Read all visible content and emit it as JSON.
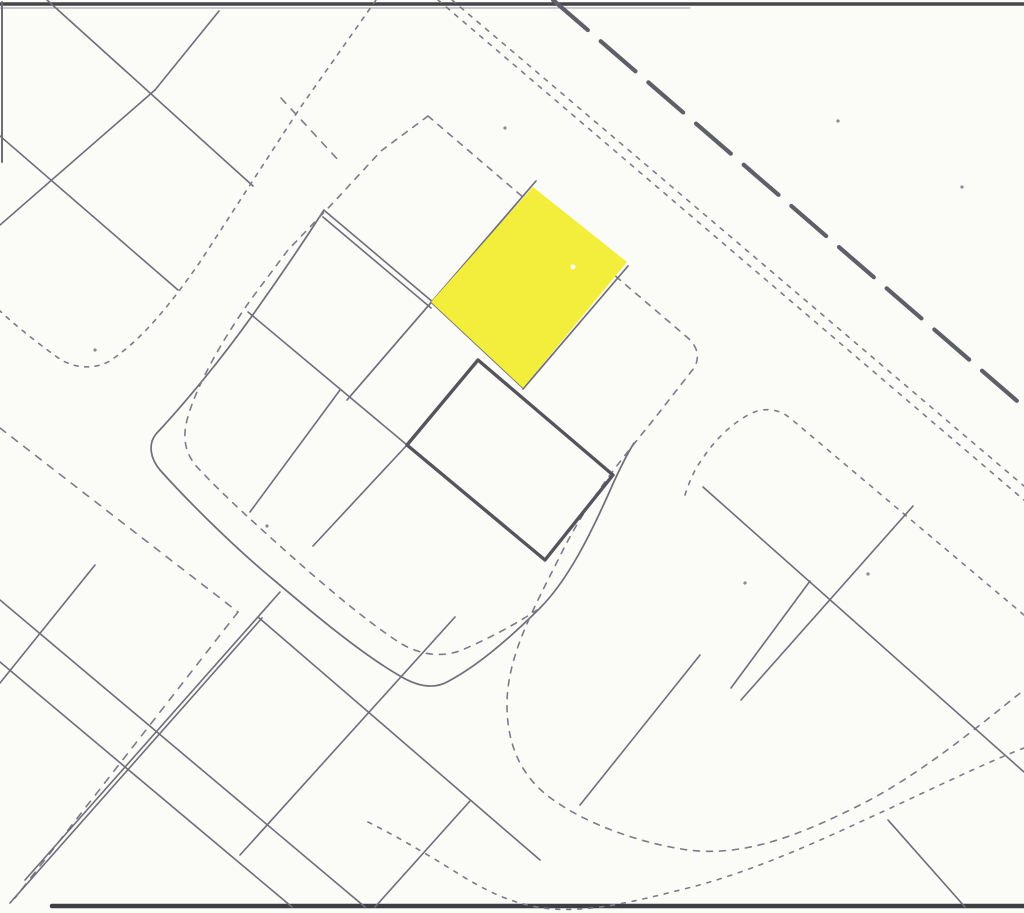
{
  "map": {
    "kind": "cadastral-parcel-plan-scan",
    "canvas": {
      "width": 1024,
      "height": 913
    },
    "palette": {
      "background": "#fbfbf8",
      "parcel_line": "#6e6e79",
      "dotted_boundary": "#7c7c87",
      "bold_parcel_outline": "#54545c",
      "road_dash": "#5f5f68",
      "scan_border": "#45454c",
      "highlight_parcel": "#f2ee3b"
    },
    "highlighted_parcel": {
      "name": "highlighted-parcel",
      "fill": "#f2ee3b",
      "corners": [
        [
          533,
          187
        ],
        [
          627,
          262
        ],
        [
          523,
          388
        ],
        [
          431,
          302
        ]
      ]
    },
    "features": [
      {
        "name": "top-scan-border",
        "type": "line",
        "x1": 0,
        "y1": 4,
        "x2": 1024,
        "y2": 4,
        "stroke": "#45454c",
        "width": 3.5
      },
      {
        "name": "top-scan-border-echo",
        "type": "line",
        "x1": 0,
        "y1": 8,
        "x2": 690,
        "y2": 8,
        "stroke": "#9a9aa2",
        "width": 1
      },
      {
        "name": "bottom-scan-border",
        "type": "line",
        "x1": 52,
        "y1": 906,
        "x2": 1024,
        "y2": 906,
        "stroke": "#3d3d44",
        "width": 4.5
      },
      {
        "name": "left-scan-border",
        "type": "line",
        "x1": 2,
        "y1": 2,
        "x2": 2,
        "y2": 162,
        "stroke": "#6d6d75",
        "width": 2
      },
      {
        "name": "road-long-dash",
        "type": "line",
        "x1": 553,
        "y1": 0,
        "x2": 1024,
        "y2": 407,
        "stroke": "#5f5f68",
        "width": 4.2,
        "dash": "46 17"
      },
      {
        "name": "road-dotted-edge-a",
        "type": "line",
        "x1": 438,
        "y1": 0,
        "x2": 1024,
        "y2": 500,
        "stroke": "#7c7c87",
        "width": 1.6,
        "dash": "4 7"
      },
      {
        "name": "road-dotted-edge-b",
        "type": "line",
        "x1": 452,
        "y1": 0,
        "x2": 1024,
        "y2": 486,
        "stroke": "#7c7c87",
        "width": 1.6,
        "dash": "4 7"
      },
      {
        "name": "topleft-parcel-line-a",
        "type": "line",
        "x1": 47,
        "y1": 0,
        "x2": 253,
        "y2": 186,
        "stroke": "#6e6e79",
        "width": 1.6
      },
      {
        "name": "topleft-parcel-line-b",
        "type": "line",
        "x1": 155,
        "y1": 90,
        "x2": 0,
        "y2": 225,
        "stroke": "#6e6e79",
        "width": 1.6
      },
      {
        "name": "topleft-parcel-line-b2",
        "type": "line",
        "x1": 155,
        "y1": 90,
        "x2": 219,
        "y2": 11,
        "stroke": "#6e6e79",
        "width": 1.6
      },
      {
        "name": "topleft-parcel-line-c",
        "type": "line",
        "x1": 0,
        "y1": 136,
        "x2": 178,
        "y2": 290,
        "stroke": "#6e6e79",
        "width": 1.6
      },
      {
        "name": "topleft-block-dotted-boundary",
        "type": "path",
        "d": "M376 0 L300 108 L200 262 C170 305 140 342 108 362 C92 370 72 368 57 357 C36 342 15 325 0 311",
        "stroke": "#7c7c87",
        "width": 1.6,
        "dash": "4 6.5"
      },
      {
        "name": "street-dash-fragment",
        "type": "line",
        "x1": 281,
        "y1": 98,
        "x2": 340,
        "y2": 162,
        "stroke": "#7c7c87",
        "width": 1.6,
        "dash": "7 8"
      },
      {
        "name": "center-block-solid-boundary",
        "type": "path",
        "d": "M324 210 C295 255 272 288 252 316 C222 358 186 402 156 434 C148 444 150 458 160 470 C185 498 225 538 262 570 C300 602 355 650 400 676 C415 685 432 690 447 682 C478 666 512 636 540 608 C568 580 590 535 608 495 C618 472 626 456 634 443",
        "stroke": "#6e6e79",
        "width": 1.7
      },
      {
        "name": "center-block-dotted-west",
        "type": "path",
        "d": "M428 116 L381 151 L333 203 L288 250 L252 298 C222 340 196 386 187 420 C182 440 186 455 198 468 C225 497 262 530 298 562 C330 590 365 620 400 643 C420 655 442 658 462 650 C490 638 516 624 537 610",
        "stroke": "#7c7c87",
        "width": 1.6,
        "dash": "6 7"
      },
      {
        "name": "center-block-dotted-east-and-street-sweep",
        "type": "path",
        "d": "M428 116 L688 338 C698 347 700 358 694 368 L658 414 C628 452 590 495 560 556 C532 612 506 658 507 708 C508 750 524 779 552 799 C585 823 638 843 688 850 C745 857 800 835 860 805 C920 775 980 725 1024 690",
        "stroke": "#7c7c87",
        "width": 1.6,
        "dash": "6 7"
      },
      {
        "name": "street-sweep-outer-dotted",
        "type": "path",
        "d": "M368 822 C400 838 430 856 462 876 C495 896 520 906 552 909 C595 912 640 900 688 888 C740 875 800 850 860 822 C920 795 980 765 1024 748",
        "stroke": "#7c7c87",
        "width": 1.6,
        "dash": "4 7"
      },
      {
        "name": "narrow-strip-parcel-edge-a",
        "type": "line",
        "x1": 325,
        "y1": 211,
        "x2": 434,
        "y2": 303,
        "stroke": "#6e6e79",
        "width": 1.6
      },
      {
        "name": "narrow-strip-parcel-edge-b",
        "type": "line",
        "x1": 323,
        "y1": 217,
        "x2": 431,
        "y2": 308,
        "stroke": "#6e6e79",
        "width": 1.6
      },
      {
        "name": "highlight-nw-edge-line",
        "type": "line",
        "x1": 536,
        "y1": 181,
        "x2": 347,
        "y2": 400,
        "stroke": "#6e6e79",
        "width": 1.7
      },
      {
        "name": "highlight-se-edge-line",
        "type": "line",
        "x1": 628,
        "y1": 266,
        "x2": 523,
        "y2": 389,
        "stroke": "#6e6e79",
        "width": 1.7
      },
      {
        "name": "highlight-sw-edge-line",
        "type": "line",
        "x1": 431,
        "y1": 302,
        "x2": 523,
        "y2": 388,
        "stroke": "#6e6e79",
        "width": 1.7
      },
      {
        "name": "center-parcel-line-u",
        "type": "line",
        "x1": 248,
        "y1": 312,
        "x2": 407,
        "y2": 445,
        "stroke": "#6e6e79",
        "width": 1.6
      },
      {
        "name": "center-parcel-line-v1",
        "type": "line",
        "x1": 340,
        "y1": 390,
        "x2": 250,
        "y2": 512,
        "stroke": "#6e6e79",
        "width": 1.6
      },
      {
        "name": "center-parcel-line-v2",
        "type": "line",
        "x1": 407,
        "y1": 445,
        "x2": 313,
        "y2": 546,
        "stroke": "#6e6e79",
        "width": 1.6
      },
      {
        "name": "street-dashed-sw1",
        "type": "line",
        "x1": 0,
        "y1": 428,
        "x2": 238,
        "y2": 612,
        "stroke": "#7c7c87",
        "width": 1.6,
        "dash": "7 8"
      },
      {
        "name": "street-dashed-sw2",
        "type": "line",
        "x1": 238,
        "y1": 612,
        "x2": 15,
        "y2": 898,
        "stroke": "#7c7c87",
        "width": 1.6,
        "dash": "7 8"
      },
      {
        "name": "bottomleft-strip-line-a",
        "type": "line",
        "x1": 0,
        "y1": 600,
        "x2": 365,
        "y2": 907,
        "stroke": "#6e6e79",
        "width": 1.6
      },
      {
        "name": "bottomleft-strip-line-b",
        "type": "line",
        "x1": 0,
        "y1": 662,
        "x2": 292,
        "y2": 907,
        "stroke": "#6e6e79",
        "width": 1.6
      },
      {
        "name": "bottomleft-cross-line-a",
        "type": "line",
        "x1": 280,
        "y1": 592,
        "x2": 25,
        "y2": 880,
        "stroke": "#6e6e79",
        "width": 1.6
      },
      {
        "name": "bottomleft-cross-line-b",
        "type": "line",
        "x1": 262,
        "y1": 618,
        "x2": 10,
        "y2": 903,
        "stroke": "#6e6e79",
        "width": 1.6
      },
      {
        "name": "bottomleft-short-line",
        "type": "line",
        "x1": 95,
        "y1": 565,
        "x2": 0,
        "y2": 683,
        "stroke": "#6e6e79",
        "width": 1.6
      },
      {
        "name": "bottommiddle-parcel-line-u",
        "type": "line",
        "x1": 258,
        "y1": 617,
        "x2": 540,
        "y2": 860,
        "stroke": "#6e6e79",
        "width": 1.6
      },
      {
        "name": "bottommiddle-parcel-line-v",
        "type": "line",
        "x1": 455,
        "y1": 617,
        "x2": 240,
        "y2": 855,
        "stroke": "#6e6e79",
        "width": 1.6
      },
      {
        "name": "bottommiddle-parcel-line-t",
        "type": "line",
        "x1": 470,
        "y1": 801,
        "x2": 375,
        "y2": 907,
        "stroke": "#6e6e79",
        "width": 1.6
      },
      {
        "name": "right-block-dotted-boundary",
        "type": "path",
        "d": "M685 495 C690 480 694 470 703 458 C714 441 730 425 748 415 C762 407 778 408 790 418 L1024 615",
        "stroke": "#7c7c87",
        "width": 1.6,
        "dash": "4 7"
      },
      {
        "name": "right-block-parcel-line-u1",
        "type": "line",
        "x1": 703,
        "y1": 487,
        "x2": 1024,
        "y2": 772,
        "stroke": "#6e6e79",
        "width": 1.6
      },
      {
        "name": "right-block-parcel-line-v1",
        "type": "line",
        "x1": 913,
        "y1": 506,
        "x2": 741,
        "y2": 700,
        "stroke": "#6e6e79",
        "width": 1.6
      },
      {
        "name": "right-block-parcel-line-v2",
        "type": "line",
        "x1": 810,
        "y1": 581,
        "x2": 731,
        "y2": 688,
        "stroke": "#6e6e79",
        "width": 1.6
      },
      {
        "name": "bottomright-parcel-line-v",
        "type": "line",
        "x1": 700,
        "y1": 655,
        "x2": 580,
        "y2": 805,
        "stroke": "#6e6e79",
        "width": 1.6
      },
      {
        "name": "bottomright-parcel-line-u",
        "type": "line",
        "x1": 888,
        "y1": 820,
        "x2": 965,
        "y2": 907,
        "stroke": "#6e6e79",
        "width": 1.6
      },
      {
        "name": "highlighted-parcel",
        "type": "polygon",
        "points": "533,187 627,262 523,388 431,302",
        "fill": "#f2ee3b"
      },
      {
        "name": "highlighted-parcel-scan-speck",
        "type": "circle",
        "cx": 573,
        "cy": 267,
        "r": 2.5,
        "fill": "#fbfbf8"
      },
      {
        "name": "bold-outlined-parcel",
        "type": "polygon",
        "points": "478,360 613,475 545,560 407,445",
        "fill": "none",
        "stroke": "#54545c",
        "width": 3.4
      },
      {
        "name": "scan-speck-1",
        "type": "circle",
        "cx": 838,
        "cy": 121,
        "r": 1.6,
        "fill": "#8a8a92"
      },
      {
        "name": "scan-speck-2",
        "type": "circle",
        "cx": 962,
        "cy": 187,
        "r": 1.6,
        "fill": "#8a8a92"
      },
      {
        "name": "scan-speck-3",
        "type": "circle",
        "cx": 745,
        "cy": 583,
        "r": 1.6,
        "fill": "#8a8a92"
      },
      {
        "name": "scan-speck-4",
        "type": "circle",
        "cx": 267,
        "cy": 526,
        "r": 1.6,
        "fill": "#8a8a92"
      },
      {
        "name": "scan-speck-5",
        "type": "circle",
        "cx": 868,
        "cy": 574,
        "r": 1.6,
        "fill": "#8a8a92"
      },
      {
        "name": "scan-speck-6",
        "type": "circle",
        "cx": 95,
        "cy": 350,
        "r": 1.6,
        "fill": "#8a8a92"
      },
      {
        "name": "scan-speck-7",
        "type": "circle",
        "cx": 505,
        "cy": 128,
        "r": 1.6,
        "fill": "#8a8a92"
      }
    ]
  }
}
